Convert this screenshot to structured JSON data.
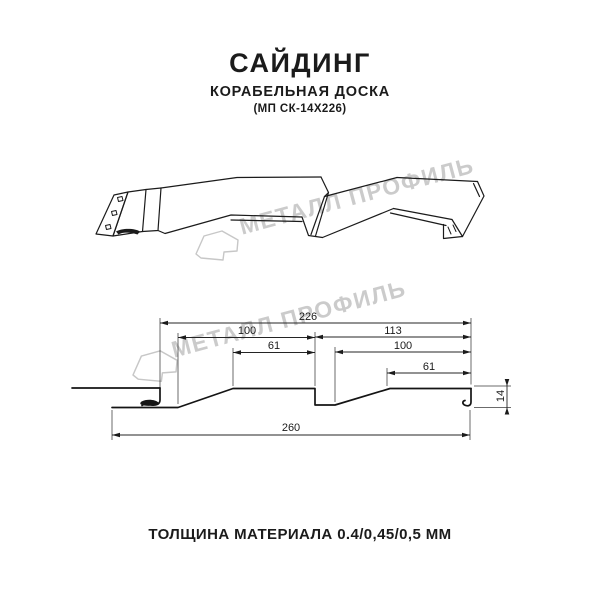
{
  "header": {
    "title": "САЙДИНГ",
    "subtitle": "КОРАБЕЛЬНАЯ ДОСКА",
    "model": "(МП СК-14Х226)"
  },
  "watermark": {
    "text": "МЕТАЛЛ ПРОФИЛЬ",
    "logo_icon": "metall-profil-logo",
    "color": "#c3c3c3"
  },
  "footer": {
    "caption": "ТОЛЩИНА МАТЕРИАЛА 0.4/0,45/0,5 ММ"
  },
  "diagram": {
    "type": "technical-drawing",
    "views": [
      "3d-profile-view",
      "cross-section-view"
    ],
    "units": "mm",
    "line_color": "#1b1b1b",
    "dimensions": {
      "overall_top": "226",
      "left_board": "100",
      "left_board_flat": "61",
      "right_board": "113",
      "right_board_inner": "100",
      "right_board_flat": "61",
      "overall_bottom": "260",
      "height": "14"
    }
  }
}
